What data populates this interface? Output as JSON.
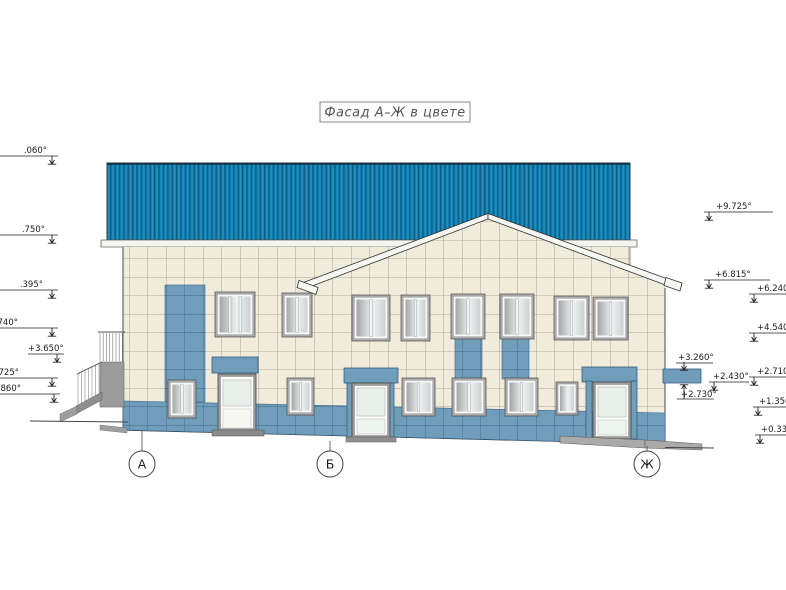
{
  "title": "Фасад А–Ж в цвете",
  "axes": [
    "А",
    "Б",
    "Ж"
  ],
  "marks": {
    "left": [
      ".060°",
      ".750°",
      ".395°",
      ".740°",
      "+3.650°",
      ".725°",
      ".860°"
    ],
    "right": [
      "+9.725°",
      "+6.815°",
      "+6.240°",
      "+4.540°",
      "+3.260°",
      "+2.430°",
      "+2.710°",
      "+2.730°",
      "+1.350°",
      "+0.330°"
    ]
  },
  "colors": {
    "roof": "#1284b6",
    "roof_stripe": "#0a5a80",
    "wall": "#f1ebdb",
    "tile_grout": "#9c9284",
    "accent": "#6f9dba",
    "accent_grout": "#3c688c",
    "frame_gray": "#9c9c9c",
    "plinth": "#a8a8a8",
    "line": "#333333"
  }
}
